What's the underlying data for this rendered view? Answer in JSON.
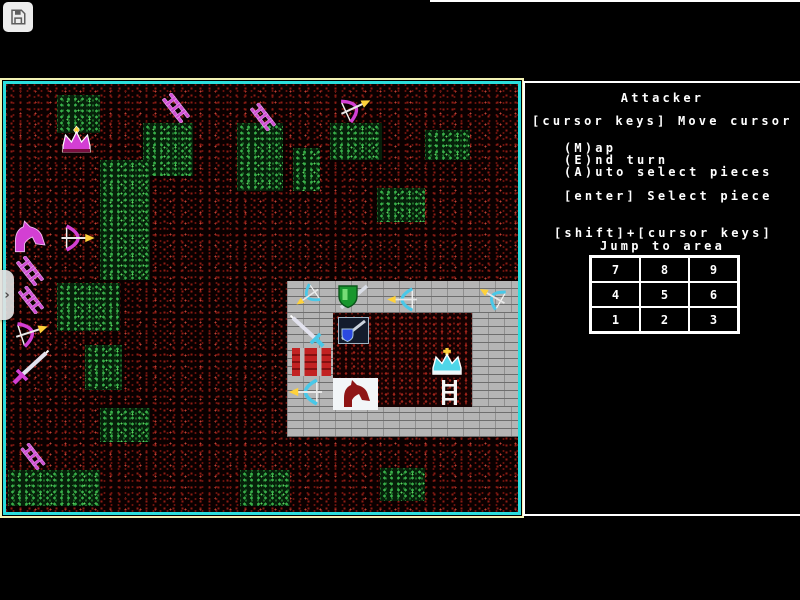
{
  "toolbar": {
    "save_icon": "floppy-disk-icon",
    "drawer_chevron": "›"
  },
  "side_panel": {
    "title": "Attacker",
    "move_cursor": "[cursor keys] Move cursor",
    "cmd_map": "(M)ap",
    "cmd_end_turn": "(E)nd turn",
    "cmd_auto_select": "(A)uto select pieces",
    "select_piece": "[enter] Select piece",
    "shift_jump": "[shift]+[cursor keys]",
    "jump_to_area": "Jump to area",
    "jump_grid": [
      [
        "7",
        "8",
        "9"
      ],
      [
        "4",
        "5",
        "6"
      ],
      [
        "1",
        "2",
        "3"
      ]
    ]
  },
  "game_map": {
    "colors": {
      "border_outer": "#f2f2b4",
      "border_inner": "#2adede",
      "ground_speckle": "#8d1d15",
      "grass": "#38b04a",
      "attacker": "#d33fd3",
      "defender": "#49c8e8",
      "castle_brick": "#b5b5b5",
      "arrow_tip": "#ffd23a"
    },
    "attacker_pieces": [
      "crown",
      "ladder",
      "ladder",
      "bow",
      "knight",
      "bow",
      "ladder",
      "ladder",
      "bow",
      "sword",
      "ladder"
    ],
    "defender_pieces": [
      "bow",
      "shield-sword",
      "bow",
      "bow",
      "sword",
      "shield-tile",
      "wall-block",
      "crown",
      "bow",
      "ladder",
      "horse-tile"
    ]
  }
}
